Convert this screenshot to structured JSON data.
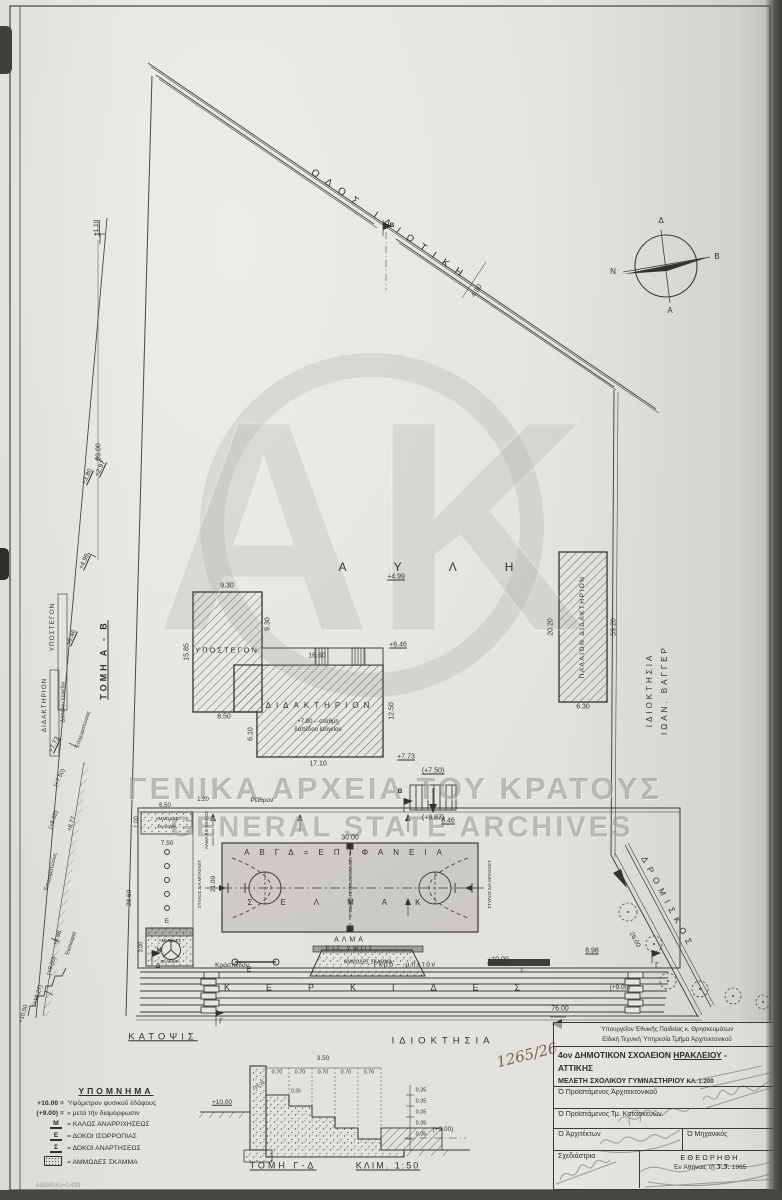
{
  "archive": {
    "watermark_line1": "ΓΕΝΙΚΑ ΑΡΧΕΙΑ ΤΟΥ ΚΡΑΤΟΥΣ",
    "watermark_line2": "GENERAL STATE ARCHIVES",
    "stamp_number": "1265/26",
    "corner_note": "Α53Χ0.81=0.439"
  },
  "compass": {
    "top": "Δ",
    "bottom": "Α",
    "left": "Ν",
    "right": "Β"
  },
  "site": {
    "road": "ΟΔΟΣ ΙΔΙΩΤΙΚΗ",
    "road_width": "4.50",
    "section_marker_b": "Β",
    "boundary_length": "99.00",
    "courtyard": "ΑΥΛΗ",
    "path": "ΔΡΟΜΙΣΚΟΣ",
    "path_length": "26.00",
    "property_bottom": "ΙΔΙΟΚΤΗΣΙΑ",
    "property_right_line1": "ΙΔΙΟΚΤΗΣΙΑ",
    "property_right_line2": "ΙΩΑΝ. ΒΑΓΓΕΡ",
    "plan_title": "ΚΑΤΟΨΙΣ",
    "spot_elevations": {
      "e110": "+1.10",
      "e380": "+3.80",
      "e297": "+2.97",
      "e499": "+4.99"
    }
  },
  "shed": {
    "name": "ΥΠΟΣΤΕΓΟΝ",
    "dim_top": "9.30",
    "dim_right": "9.30",
    "dim_left": "15.85",
    "dim_bottom": "8.50",
    "dim_notch": "6.10"
  },
  "school": {
    "name": "ΔΙΔΑΚΤΗΡΙΟΝ",
    "dim_porch": "16.60",
    "dim_bottom": "17.10",
    "dim_right": "12.50",
    "level_note_1": "+7.80 – στάθμη",
    "level_note_2": "δαπέδου ἰσογείου",
    "spot_499": "+4.99",
    "spot_646": "+6.46",
    "spot_773": "+7.73"
  },
  "old_school": {
    "name": "ΠΑΛΑΙΟΝ ΔΙΔΑΚΤΗΡΙΟΝ",
    "dim_left": "20.20",
    "dim_right": "59.20",
    "dim_bottom": "6.30"
  },
  "stairs": {
    "top_level": "(+7.50)",
    "bottom_level": "(+8.87)",
    "marker": "Β"
  },
  "court": {
    "surface_line1": "ΑΒΓΔ=ΕΠΙΦΑΝΕΙΑ",
    "surface_line2": "ΣΕΛΜΑΚ",
    "dim_w": "30.00",
    "dim_h": "21.00",
    "dim_846": "8.46",
    "volley_note": "ΥΠΟΔΟΧΗ ΣΤΥΛΩΝ ΒΟΛΛΕΥ",
    "basket_left": "ΣΤΥΛΟΣ ΔΙΑ ΜΠΑΣΚΕΤ",
    "basket_right": "ΣΤΥΛΟΣ ΔΙΑ ΜΠΑΣΚΕΤ.",
    "gutter": "Ρεῖθρον",
    "gutter_w": "1.20"
  },
  "field": {
    "lj_pit_line1": "ΑΜΜΩΔΕΣ",
    "lj_pit_line2": "ΣΚΑΜΜΑ",
    "lj_label": "ΑΛΜΑ ΕΙΣ ΜΗΚΟΣ",
    "lj_w": "6.50",
    "lj_h": "1.00",
    "lj_off": "7.50",
    "zone_h": "28.60",
    "hj_line1": "ΑΛΜΑ",
    "hj_line2": "ΕΙΣ ΥΨΟΣ",
    "hj_pit": "ΑΜΜΩΔΕΣ ΣΚΑΜΜΑ",
    "pit2_line1": "ΑΜΜΩΔΕΣ",
    "pit2_line2": "ΣΚΑΜΜΑ",
    "pit2_sym": "Μ",
    "pit2_w": "3.00",
    "curb": "Κράσπεδον",
    "gros_beton": "Γκρό - μπετόν",
    "spot_1000": "+10.00",
    "dim_898": "8.98",
    "marker_d": "Δ",
    "marker_e": "Ε",
    "marker_e2": "Ε",
    "marker_s": "Σ",
    "marker_g": "Γ",
    "marker_g2": "Γ",
    "stands": "ΚΕΡΚΙΔΕΣ",
    "stands_len": "76.00",
    "spot_900": "(+9.00)"
  },
  "section_ab": {
    "title": "ΤΟΜΗ Α - Β",
    "shed": "ΥΠΟΣΤΕΓΟΝ",
    "school": "ΔΙΔΑΚΤΗΡΙΟΝ",
    "floor_note": "Δάπεδον Ἰσογείου",
    "fill_1": "Ἐπιχωματώσεις",
    "fill_2": "Ἐπιχωματώσεις",
    "cut": "Ἐκσκαφαί",
    "s646": "+6.46",
    "s773": "+7.73",
    "s750": "(+7.50)",
    "s882": "(+8.82)",
    "s877": "+8.77",
    "s898": "+8.98",
    "s900": "(+9.00)",
    "s1027": "(+10.27)",
    "s1000": "+10.00"
  },
  "section_gd": {
    "title": "ΤΟΜΗ Γ-Δ",
    "scale": "ΚΛΙΜ. 1:50",
    "dim_top": "3.50",
    "d070": [
      "0.70",
      "0.70",
      "0.70",
      "0.70",
      "0.70"
    ],
    "d035_top": "0.35",
    "d035": [
      "0.35",
      "0.35",
      "0.35",
      "0.35",
      "0.35"
    ],
    "left_level": "+10.00",
    "right_level": "(+9.00)",
    "step_level": "+10.35"
  },
  "legend": {
    "title": "ΥΠΟΜΝΗΜΑ",
    "row1_sym": "+10.00 =",
    "row1": "Ὑψόμετρον φυσικοῦ ἐδάφους",
    "row2_sym": "(+9.00) =",
    "row2": "»  μετά τήν διαμόρφωσιν",
    "m_sym": "Μ",
    "m": "= ΚΑΛΩΣ ΑΝΑΡΡΙΧΗΣΕΩΣ",
    "e_sym": "Ε",
    "e": "= ΔΟΚΟΙ ΙΣΟΡΡΟΠΙΑΣ",
    "s_sym": "Σ",
    "s": "= ΔΟΚΟΙ ΑΝΑΡΤΗΣΕΩΣ",
    "pit": "= ΑΜΜΩΔΕΣ ΣΚΑΜΜΑ"
  },
  "title_block": {
    "agency_1": "Ὑπουργεῖον Ἐθνικῆς Παιδείας κ. Θρησκευμάτων",
    "agency_2": "Εἰδική Τεχνική Ὑπηρεσία Τμῆμα Ἀρχιτεκτονικοῦ",
    "project_1a": "4ον ΔΗΜΟΤΙΚΟΝ ΣΧΟΛΕΙΟΝ",
    "project_1b": "ΗΡΑΚΛΕΙΟΥ",
    "project_1c": "-",
    "project_2": "ΑΤΤΙΚΗΣ",
    "study": "ΜΕΛΕΤΗ ΣΧΟΛΙΚΟΥ ΓΥΜΝΑΣΤΗΡΙΟΥ",
    "scale": "ΚΛ. 1:200",
    "head_architect": "Ὁ Προϊστάμενος Ἀρχιτεκτονικοῦ",
    "head_construction": "Ὁ Προϊστάμενος Τμ. Κατασκευῶν",
    "architect": "Ὁ Ἀρχιτέκτων",
    "engineer": "Ὁ Μηχανικός",
    "draftswoman": "Σχεδιάστρια",
    "approved": "ΕΘΕΩΡΗΘΗ",
    "approved_at": "Ἐν Ἀθήναις τῇ",
    "approved_date": "5.5.",
    "approved_year": "1965"
  }
}
